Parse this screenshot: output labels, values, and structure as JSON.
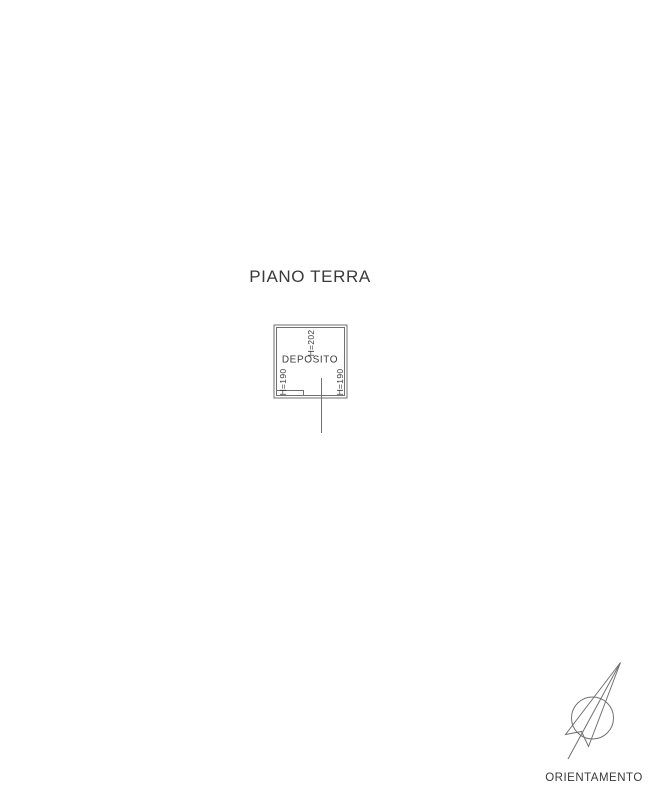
{
  "page": {
    "background_color": "#ffffff",
    "line_color": "#707070",
    "text_color": "#3a3a3a"
  },
  "plan": {
    "title": "PIANO TERRA",
    "room": {
      "name": "DEPOSITO",
      "ceiling_height_top": "H=202",
      "ceiling_height_left": "H=190",
      "ceiling_height_right": "H=190"
    },
    "compass": {
      "label": "ORIENTAMENTO"
    }
  }
}
